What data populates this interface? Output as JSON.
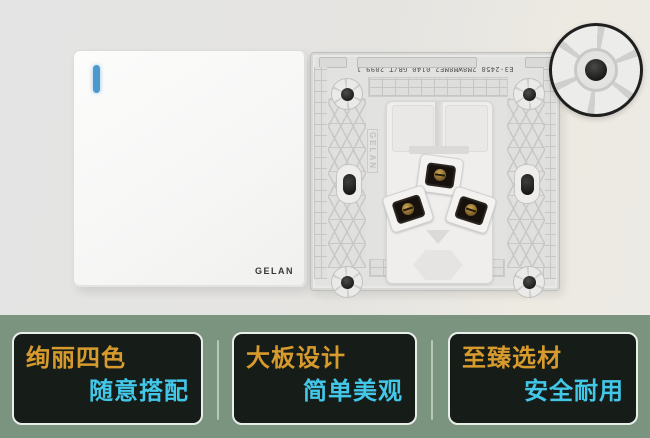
{
  "banner": {
    "brand": "GELAN",
    "socket_code": "E3-2458 2M8WM8ME2 0140 GB/T 2099.1",
    "colors": {
      "band_bg": "#7b9480",
      "card_bg": "#161c18",
      "card_border": "#e8eee8",
      "title_color": "#d79a2c",
      "subtitle_color": "#43c7e8",
      "indicator_blue": "#4a9ace"
    },
    "features": [
      {
        "title": "绚丽四色",
        "subtitle": "随意搭配"
      },
      {
        "title": "大板设计",
        "subtitle": "简单美观"
      },
      {
        "title": "至臻选材",
        "subtitle": "安全耐用"
      }
    ]
  }
}
